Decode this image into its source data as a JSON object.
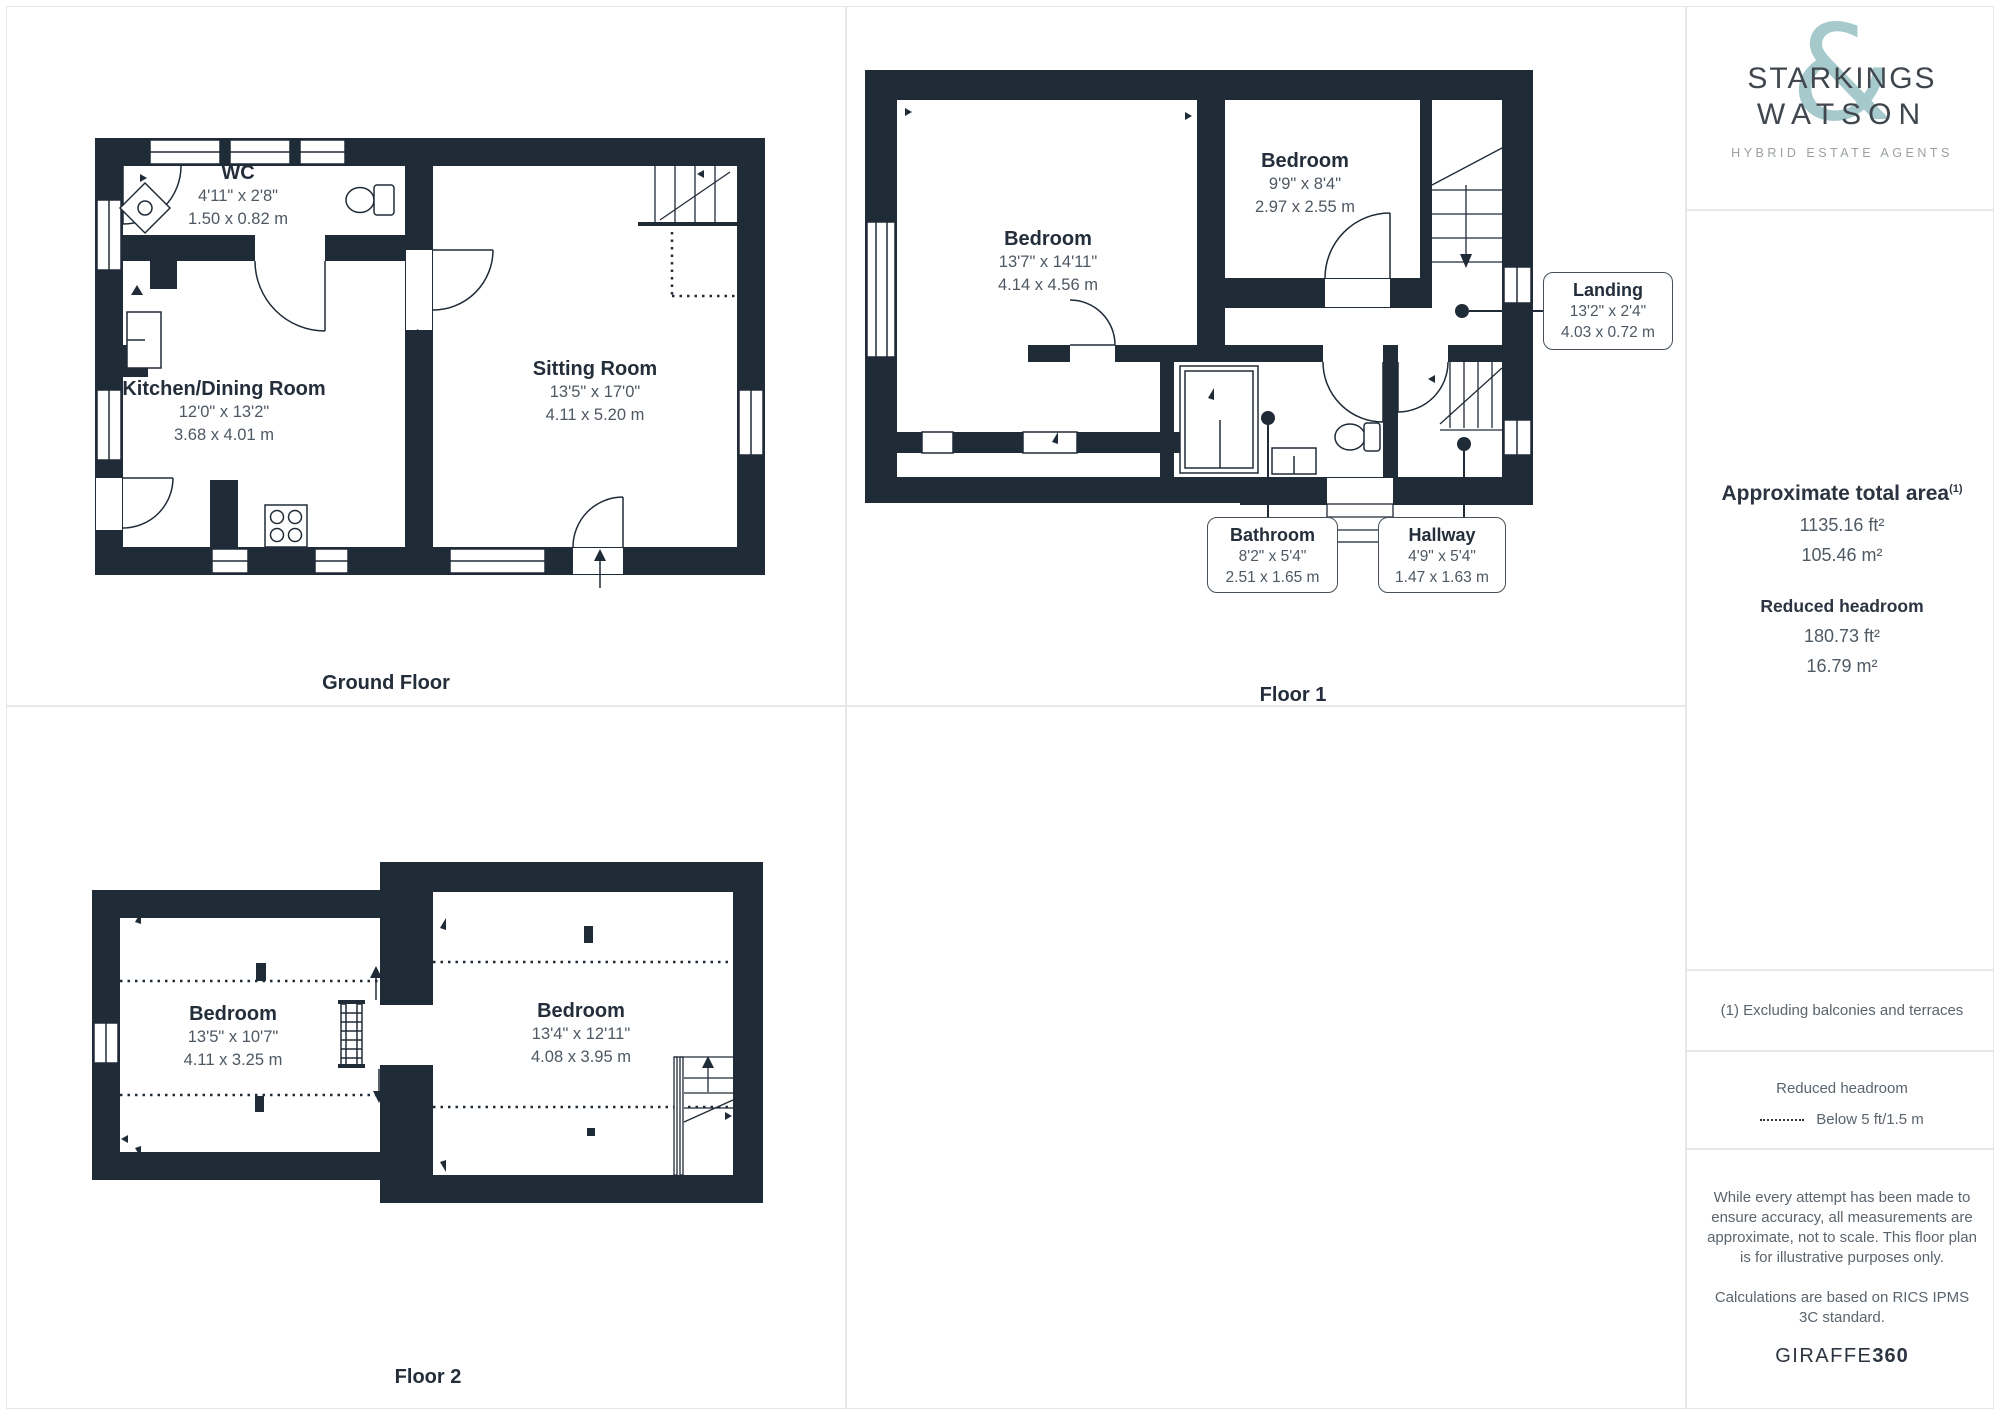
{
  "branding": {
    "name_line1": "STARKINGS",
    "name_line2": "WATSON",
    "ampersand": "&",
    "tagline": "HYBRID ESTATE AGENTS"
  },
  "sidebar": {
    "total_area_title": "Approximate total area",
    "total_area_footnote_marker": "(1)",
    "total_area_ft": "1135.16 ft²",
    "total_area_m": "105.46 m²",
    "reduced_headroom_title": "Reduced headroom",
    "reduced_headroom_ft": "180.73 ft²",
    "reduced_headroom_m": "16.79 m²",
    "footnote": "(1) Excluding balconies and terraces",
    "legend_title": "Reduced headroom",
    "legend_label": "Below 5 ft/1.5 m",
    "disclaimer_1": "While every attempt has been made to ensure accuracy, all measurements are approximate, not to scale. This floor plan is for illustrative purposes only.",
    "disclaimer_2": "Calculations are based on RICS IPMS 3C standard.",
    "provider_name": "GIRAFFE",
    "provider_suffix": "360"
  },
  "floors": {
    "ground": {
      "title": "Ground Floor",
      "rooms": {
        "wc": {
          "name": "WC",
          "imperial": "4'11\" x 2'8\"",
          "metric": "1.50 x 0.82 m"
        },
        "kitchen": {
          "name": "Kitchen/Dining Room",
          "imperial": "12'0\" x 13'2\"",
          "metric": "3.68 x 4.01 m"
        },
        "sitting": {
          "name": "Sitting Room",
          "imperial": "13'5\" x 17'0\"",
          "metric": "4.11 x 5.20 m"
        }
      }
    },
    "floor1": {
      "title": "Floor 1",
      "rooms": {
        "bedroom1": {
          "name": "Bedroom",
          "imperial": "13'7\" x 14'11\"",
          "metric": "4.14 x 4.56 m"
        },
        "bedroom2": {
          "name": "Bedroom",
          "imperial": "9'9\" x 8'4\"",
          "metric": "2.97 x 2.55 m"
        },
        "landing": {
          "name": "Landing",
          "imperial": "13'2\" x 2'4\"",
          "metric": "4.03 x 0.72 m"
        },
        "bathroom": {
          "name": "Bathroom",
          "imperial": "8'2\" x 5'4\"",
          "metric": "2.51 x 1.65 m"
        },
        "hallway": {
          "name": "Hallway",
          "imperial": "4'9\" x 5'4\"",
          "metric": "1.47 x 1.63 m"
        }
      }
    },
    "floor2": {
      "title": "Floor 2",
      "rooms": {
        "bedroom1": {
          "name": "Bedroom",
          "imperial": "13'5\" x 10'7\"",
          "metric": "4.11 x 3.25 m"
        },
        "bedroom2": {
          "name": "Bedroom",
          "imperial": "13'4\" x 12'11\"",
          "metric": "4.08 x 3.95 m"
        }
      }
    }
  },
  "colors": {
    "wall": "#202b38",
    "accent_teal": "#a6c9cc",
    "dim_text": "#4d5863",
    "divider": "#e6e7e9"
  }
}
